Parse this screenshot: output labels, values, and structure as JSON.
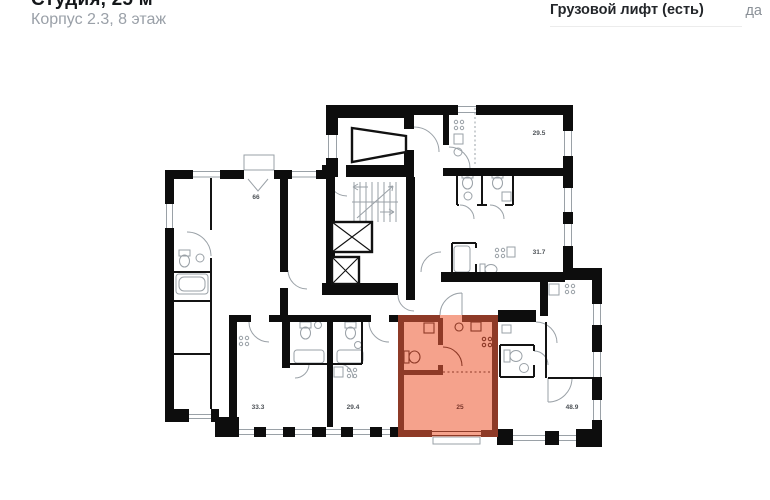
{
  "header": {
    "title": "Студия, 25 м²",
    "subtitle": "Корпус 2.3, 8 этаж"
  },
  "info": {
    "label": "Грузовой лифт (есть)",
    "value": "да"
  },
  "floorplan": {
    "unit_area_label": "25",
    "rooms": [
      {
        "label": "66"
      },
      {
        "label": "29.5"
      },
      {
        "label": "31.7"
      },
      {
        "label": "33.3"
      },
      {
        "label": "29.4"
      },
      {
        "label": "48.9"
      }
    ],
    "colors": {
      "wall": "#0d0d0d",
      "line": "#9aa1a7",
      "window": "#b8bcc0",
      "label": "#4d5257",
      "highlight_fill": "#f5a28c",
      "highlight_wall": "#8e3a27",
      "highlight_label": "#79352a"
    }
  }
}
